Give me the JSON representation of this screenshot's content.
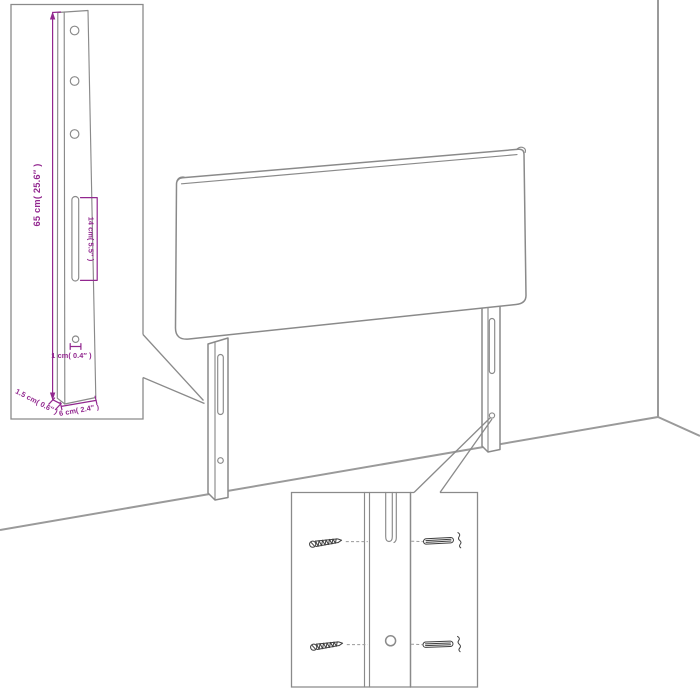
{
  "diagram": {
    "callout_bracket": {
      "total_height_label": "65 cm( 25.6″ )",
      "slot_height_label": "14 cm( 5.5″ )",
      "hole_diameter_label": "1 cm( 0.4″ )",
      "thickness_label": "1.5 cm( 0.6″ )",
      "width_label": "6 cm( 2.4″ )"
    },
    "colors": {
      "dimension_text": "#92278f",
      "outline": "#8a8a8a",
      "wall_line": "#9a9a9a",
      "hardware": "#3f3f3f",
      "background": "#ffffff"
    }
  }
}
